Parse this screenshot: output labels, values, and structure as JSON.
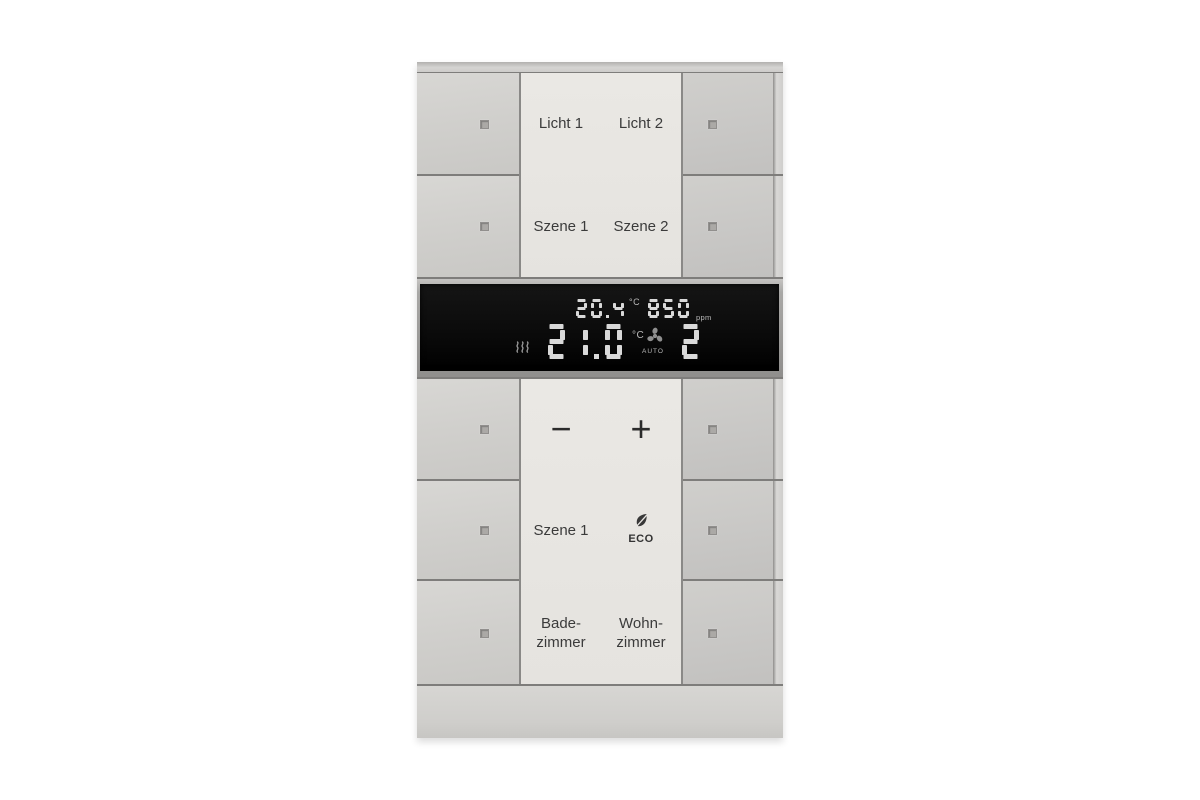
{
  "device": {
    "kind": "KNX room control unit with thermostat display",
    "upper": {
      "row1_left": "Licht 1",
      "row1_right": "Licht 2",
      "row2_left": "Szene 1",
      "row2_right": "Szene 2"
    },
    "lower": {
      "minus": "−",
      "plus": "+",
      "scene": "Szene 1",
      "eco": "ECO",
      "room1_line1": "Bade-",
      "room1_line2": "zimmer",
      "room2_line1": "Wohn-",
      "room2_line2": "zimmer"
    },
    "display": {
      "room_temperature": "20.4",
      "room_temperature_unit": "°C",
      "air_quality": "850",
      "air_quality_unit": "ppm",
      "setpoint_temperature": "21.0",
      "setpoint_unit": "°C",
      "fan_mode": "AUTO",
      "fan_stage": "2"
    },
    "icons": {
      "heating": "heating-waves-icon",
      "fan": "fan-icon",
      "eco": "eco-leaf-icon",
      "led_window": "led-indicator"
    },
    "colors": {
      "frame": "#cfcecb",
      "button": "#cdccc9",
      "label_panel": "#e8e6e2",
      "display_background": "#0d0d0d",
      "display_digits": "#d9d9d9",
      "label_text": "#3b3b3b"
    }
  }
}
